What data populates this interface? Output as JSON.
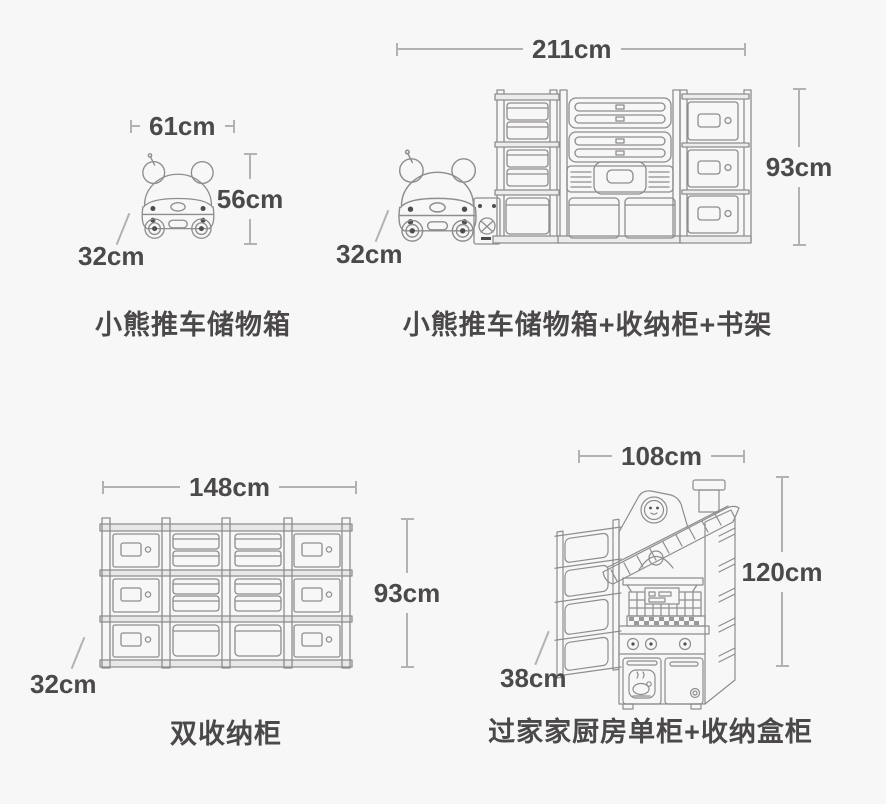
{
  "page": {
    "background": "#f8f7f7",
    "text_color": "#4b4949",
    "dim_line_color": "#b3b1b1",
    "drawing_line_color": "#8e8c8c"
  },
  "products": [
    {
      "key": "bear-cart-storage-box",
      "label": "小熊推车储物箱",
      "width_label": "61cm",
      "height_label": "56cm",
      "depth_label": "32cm"
    },
    {
      "key": "bear-cart-storage-box-combo",
      "label": "小熊推车储物箱+收纳柜+书架",
      "width_label": "211cm",
      "height_label": "93cm",
      "depth_label": "32cm"
    },
    {
      "key": "double-storage-cabinet",
      "label": "双收纳柜",
      "width_label": "148cm",
      "height_label": "93cm",
      "depth_label": "32cm"
    },
    {
      "key": "play-kitchen-single-cabinet-combo",
      "label": "过家家厨房单柜+收纳盒柜",
      "width_label": "108cm",
      "height_label": "120cm",
      "depth_label": "38cm"
    }
  ]
}
